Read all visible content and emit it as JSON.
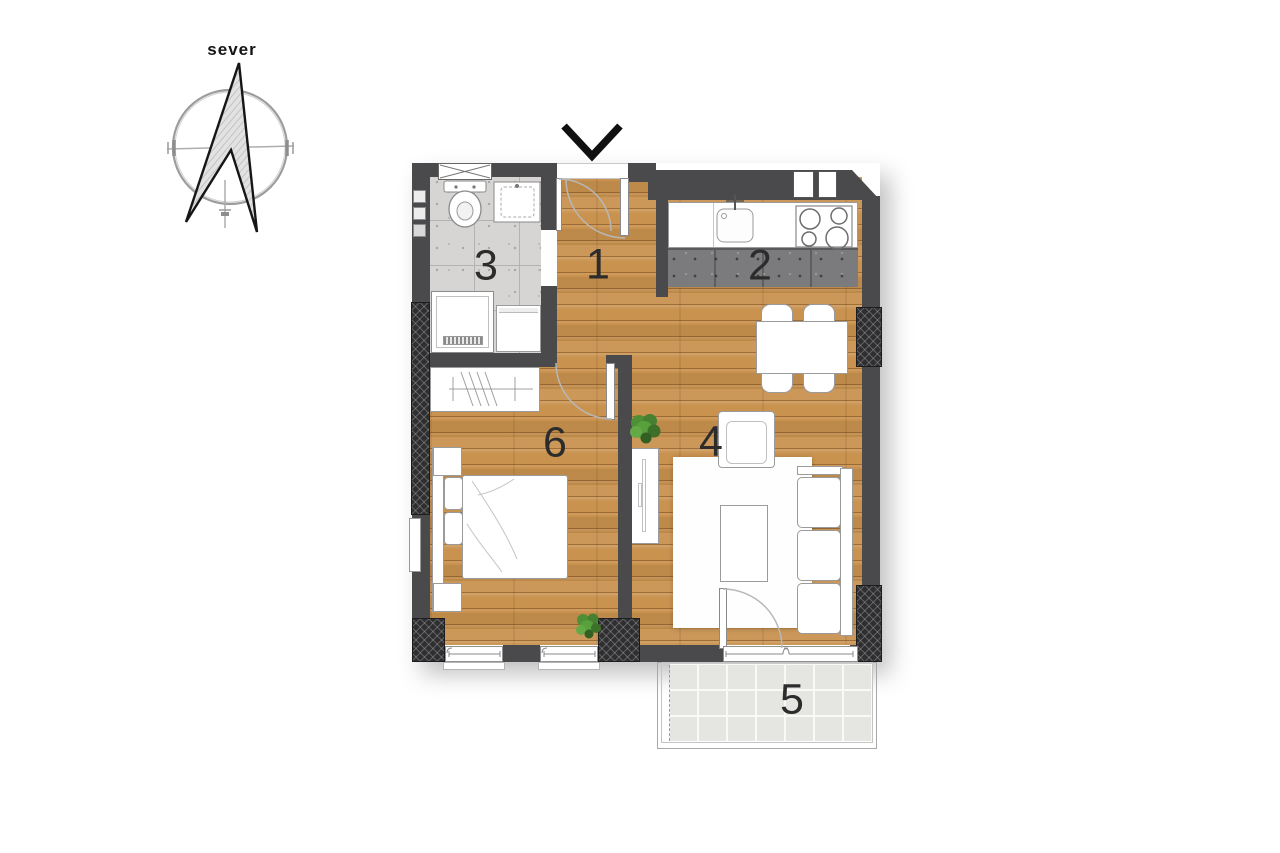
{
  "compass": {
    "label": "sever"
  },
  "rooms": {
    "hallway": {
      "number": "1"
    },
    "kitchen": {
      "number": "2"
    },
    "bathroom": {
      "number": "3"
    },
    "living_room": {
      "number": "4"
    },
    "balcony": {
      "number": "5"
    },
    "bedroom": {
      "number": "6"
    }
  },
  "colors": {
    "wall": "#4a4a4c",
    "wood_floor": "#c9924f",
    "bathroom_tile": "#d6d5d3",
    "kitchen_tile": "#7b7b7e",
    "balcony_tile": "#e5e5e2",
    "outline_gray": "#9b9b9b",
    "plant_green": "#4f8f35"
  }
}
